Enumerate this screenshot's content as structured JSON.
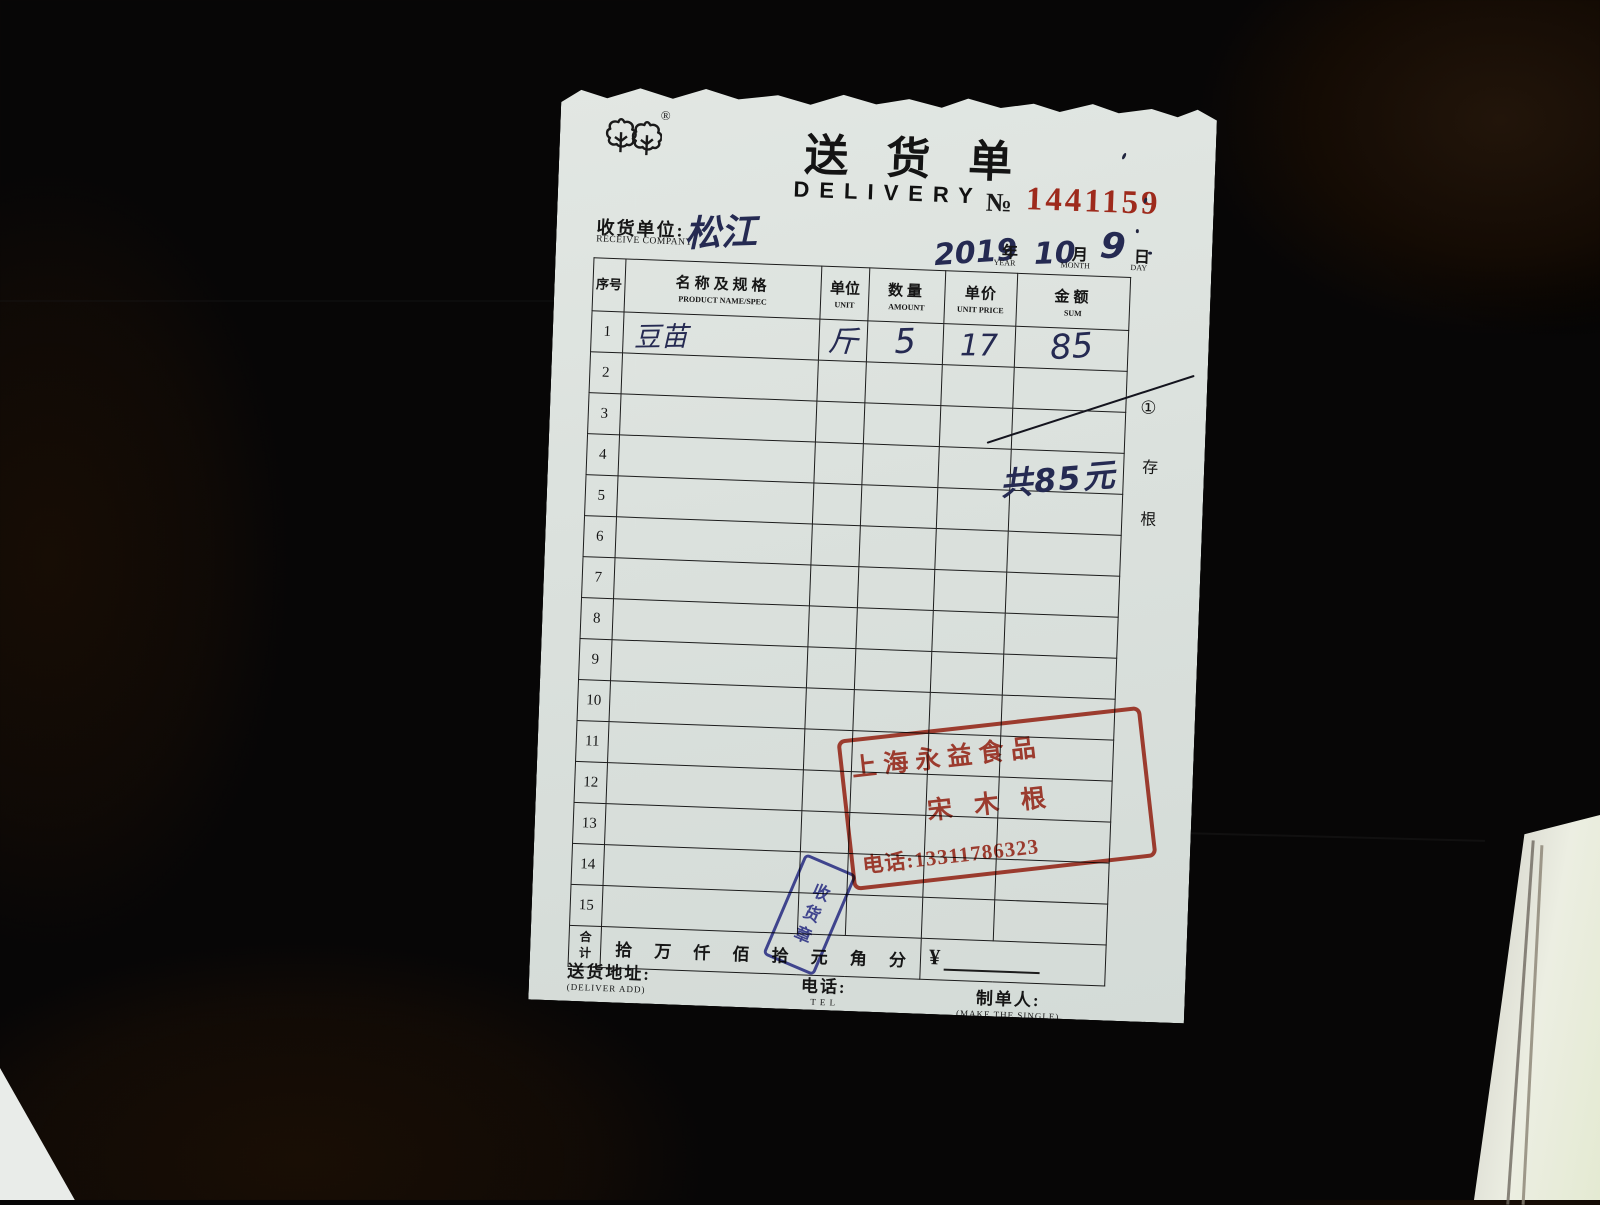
{
  "receipt": {
    "registered_mark": "®",
    "title_cn": "送货单",
    "title_en": "DELIVERY",
    "no_label": "№",
    "no_value": "1441159",
    "receiver": {
      "label_cn": "收货单位:",
      "label_en": "RECEIVE COMPANY",
      "value_handwritten": "松江"
    },
    "date": {
      "year_value": "2019",
      "year_label": "年",
      "year_en": "YEAR",
      "month_value": "10",
      "month_label": "月",
      "month_en": "MONTH",
      "day_value": "9",
      "day_label": "日",
      "day_en": "DAY"
    },
    "table": {
      "headers": [
        {
          "cn": "序号",
          "en": ""
        },
        {
          "cn": "名称及规格",
          "en": "PRODUCT NAME/SPEC"
        },
        {
          "cn": "单位",
          "en": "UNIT"
        },
        {
          "cn": "数量",
          "en": "AMOUNT"
        },
        {
          "cn": "单价",
          "en": "UNIT PRICE"
        },
        {
          "cn": "金额",
          "en": "SUM"
        }
      ],
      "rows": [
        {
          "no": "1",
          "name": "豆苗",
          "unit": "斤",
          "amount": "5",
          "unit_price": "17",
          "sum": "85"
        },
        {
          "no": "2",
          "name": "",
          "unit": "",
          "amount": "",
          "unit_price": "",
          "sum": ""
        },
        {
          "no": "3",
          "name": "",
          "unit": "",
          "amount": "",
          "unit_price": "",
          "sum": ""
        },
        {
          "no": "4",
          "name": "",
          "unit": "",
          "amount": "",
          "unit_price": "",
          "sum": ""
        },
        {
          "no": "5",
          "name": "",
          "unit": "",
          "amount": "",
          "unit_price": "",
          "sum": ""
        },
        {
          "no": "6",
          "name": "",
          "unit": "",
          "amount": "",
          "unit_price": "",
          "sum": ""
        },
        {
          "no": "7",
          "name": "",
          "unit": "",
          "amount": "",
          "unit_price": "",
          "sum": ""
        },
        {
          "no": "8",
          "name": "",
          "unit": "",
          "amount": "",
          "unit_price": "",
          "sum": ""
        },
        {
          "no": "9",
          "name": "",
          "unit": "",
          "amount": "",
          "unit_price": "",
          "sum": ""
        },
        {
          "no": "10",
          "name": "",
          "unit": "",
          "amount": "",
          "unit_price": "",
          "sum": ""
        },
        {
          "no": "11",
          "name": "",
          "unit": "",
          "amount": "",
          "unit_price": "",
          "sum": ""
        },
        {
          "no": "12",
          "name": "",
          "unit": "",
          "amount": "",
          "unit_price": "",
          "sum": ""
        },
        {
          "no": "13",
          "name": "",
          "unit": "",
          "amount": "",
          "unit_price": "",
          "sum": ""
        },
        {
          "no": "14",
          "name": "",
          "unit": "",
          "amount": "",
          "unit_price": "",
          "sum": ""
        },
        {
          "no": "15",
          "name": "",
          "unit": "",
          "amount": "",
          "unit_price": "",
          "sum": ""
        }
      ],
      "total_row": {
        "label": "合计",
        "digits": "拾万仟佰拾元角分",
        "currency": "¥"
      }
    },
    "annotations": {
      "handwritten_total": "共85元"
    },
    "stub": {
      "copy_number": "①",
      "char1": "存",
      "char2": "根"
    },
    "side_brand": "强林纸品",
    "red_stamp": {
      "line1": "上海永益食品",
      "line2": "宋木根",
      "line3": "电话:13311786323",
      "color": "#b23425"
    },
    "blue_stamp": {
      "text": "收货章",
      "color": "#3b3f9f"
    },
    "footer": {
      "address_cn": "送货地址:",
      "address_en": "(DELIVER ADD)",
      "tel_cn": "电话:",
      "tel_en": "T E L",
      "maker_cn": "制单人:",
      "maker_en": "(MAKE THE SINGLE)"
    }
  }
}
